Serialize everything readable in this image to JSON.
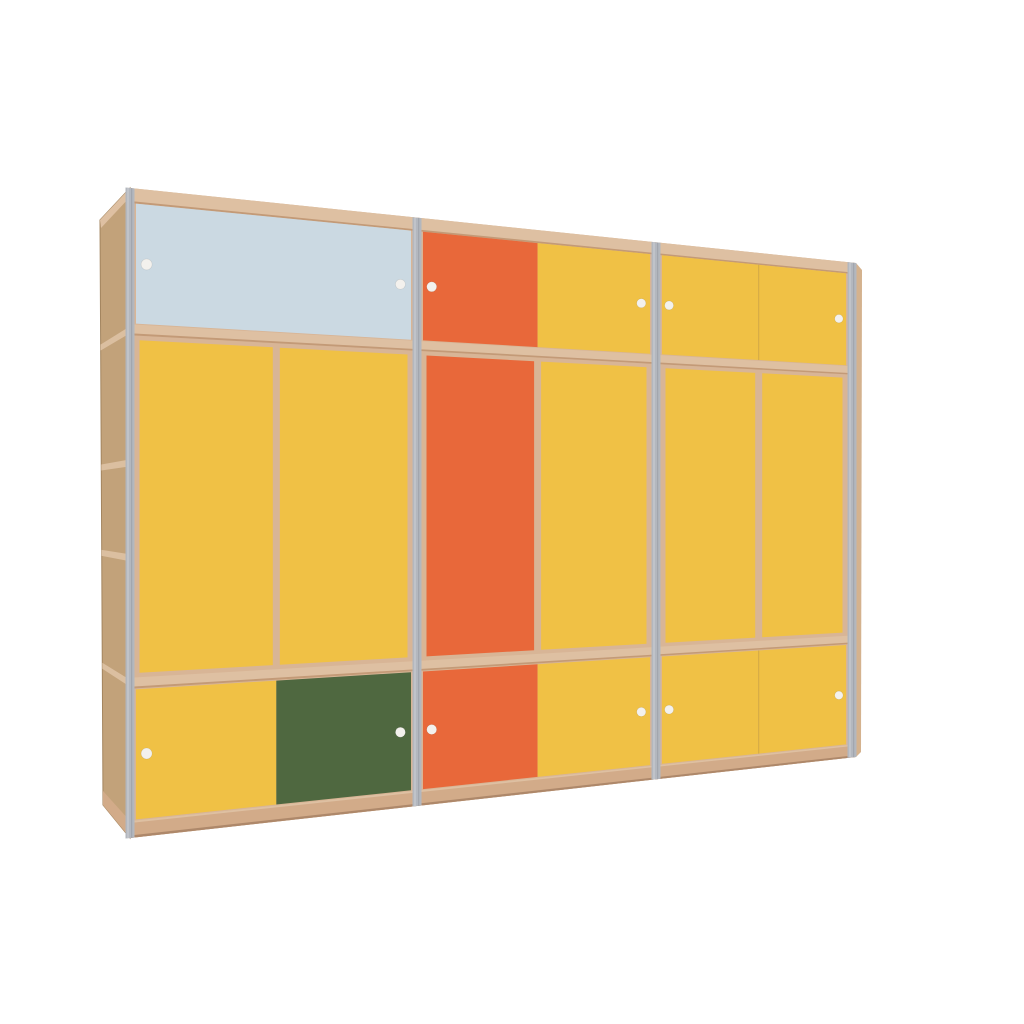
{
  "scene": {
    "background": "#ffffff",
    "label": "3D render of a three-bay plywood wardrobe with pale-blue, yellow, orange and green doors and round white knobs"
  },
  "palette": {
    "yellow": "#F0C145",
    "orange": "#E8683A",
    "blue": "#CBD9E2",
    "green": "#4F6840",
    "frame": "#D8B596",
    "frameLight": "#DEC0A2",
    "frameEdge": "#C39A77",
    "base": "#D2AB89",
    "baseDark": "#AE886A",
    "sideWood": "#C2A27A",
    "sideLine": "#DBBFA0",
    "sideEdge": "#A3855F",
    "sliver": "#D4B28E",
    "metal": "#B3B7BE",
    "metalLight": "#C9CBD0",
    "metalDark": "#9EA2AB",
    "handle": "#F3F1ED",
    "seam": "rgba(60,35,15,0.13)"
  },
  "geometry": {
    "front": {
      "tl": [
        130,
        188
      ],
      "tr": [
        856,
        263
      ],
      "bl": [
        130,
        838
      ],
      "br": [
        856,
        757
      ]
    },
    "sideOuter": {
      "top": [
        100,
        220
      ],
      "bottom": [
        103,
        805
      ]
    },
    "sectionX": [
      130,
      417,
      656,
      852
    ],
    "rowT": [
      0,
      0.218,
      0.762,
      1
    ],
    "sideShelfT": [
      0.218,
      0.423,
      0.569,
      0.762
    ],
    "thickness": {
      "topFrame": 15,
      "divider": 11,
      "plinth": 17,
      "metal": 9,
      "tallReveal": 5,
      "edgeInset": 1.5,
      "doorGap": 7
    },
    "handleInsetFrac": 0.038,
    "handleRadius": 5.5
  },
  "sections": [
    {
      "name": "bay-1",
      "rows": [
        {
          "name": "top",
          "doors": [
            {
              "name": "bay1-top-door",
              "color": "blue",
              "from": 0,
              "to": 1,
              "handles": [
                "left",
                "right"
              ]
            }
          ]
        },
        {
          "name": "middle",
          "tall": true,
          "doors": [
            {
              "name": "bay1-wardrobe-door-left",
              "color": "yellow",
              "from": 0,
              "to": 0.51
            },
            {
              "name": "bay1-wardrobe-door-right",
              "color": "yellow",
              "from": 0.51,
              "to": 1
            }
          ]
        },
        {
          "name": "bottom",
          "doors": [
            {
              "name": "bay1-bottom-door-left",
              "color": "yellow",
              "from": 0,
              "to": 0.51,
              "handles": [
                "left"
              ]
            },
            {
              "name": "bay1-bottom-door-right",
              "color": "green",
              "from": 0.51,
              "to": 1,
              "handles": [
                "right"
              ]
            }
          ]
        }
      ]
    },
    {
      "name": "bay-2",
      "rows": [
        {
          "name": "top",
          "doors": [
            {
              "name": "bay2-top-door-left",
              "color": "orange",
              "from": 0,
              "to": 0.505,
              "handles": [
                "left"
              ]
            },
            {
              "name": "bay2-top-door-right",
              "color": "yellow",
              "from": 0.505,
              "to": 1,
              "handles": [
                "right"
              ]
            }
          ]
        },
        {
          "name": "middle",
          "tall": true,
          "doors": [
            {
              "name": "bay2-wardrobe-door-left",
              "color": "orange",
              "from": 0,
              "to": 0.505
            },
            {
              "name": "bay2-wardrobe-door-right",
              "color": "yellow",
              "from": 0.505,
              "to": 1
            }
          ]
        },
        {
          "name": "bottom",
          "doors": [
            {
              "name": "bay2-bottom-door-left",
              "color": "orange",
              "from": 0,
              "to": 0.505,
              "handles": [
                "left"
              ]
            },
            {
              "name": "bay2-bottom-door-right",
              "color": "yellow",
              "from": 0.505,
              "to": 1,
              "handles": [
                "right"
              ]
            }
          ]
        }
      ]
    },
    {
      "name": "bay-3",
      "rows": [
        {
          "name": "top",
          "seam": true,
          "doors": [
            {
              "name": "bay3-top-door-left",
              "color": "yellow",
              "from": 0,
              "to": 0.525,
              "handles": [
                "left"
              ]
            },
            {
              "name": "bay3-top-door-right",
              "color": "yellow",
              "from": 0.525,
              "to": 1,
              "handles": [
                "right"
              ]
            }
          ]
        },
        {
          "name": "middle",
          "tall": true,
          "doors": [
            {
              "name": "bay3-wardrobe-door-left",
              "color": "yellow",
              "from": 0,
              "to": 0.525
            },
            {
              "name": "bay3-wardrobe-door-right",
              "color": "yellow",
              "from": 0.525,
              "to": 1
            }
          ]
        },
        {
          "name": "bottom",
          "seam": true,
          "doors": [
            {
              "name": "bay3-bottom-door-left",
              "color": "yellow",
              "from": 0,
              "to": 0.525,
              "handles": [
                "left"
              ]
            },
            {
              "name": "bay3-bottom-door-right",
              "color": "yellow",
              "from": 0.525,
              "to": 1,
              "handles": [
                "right"
              ]
            }
          ]
        }
      ]
    }
  ]
}
